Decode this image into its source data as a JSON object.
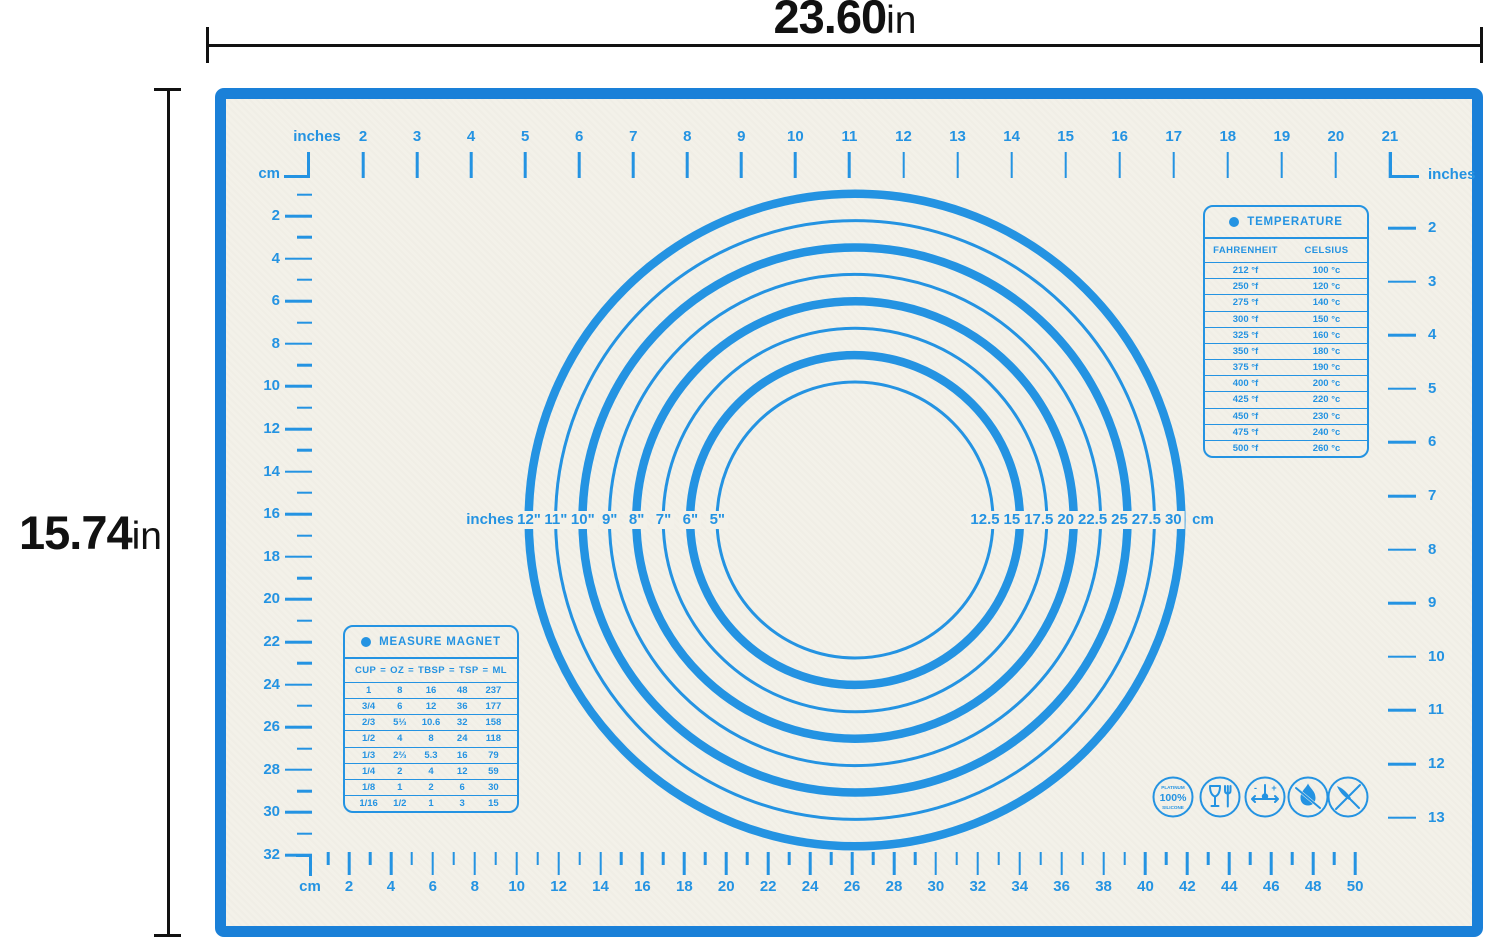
{
  "dimensions": {
    "width_value": "23.60",
    "width_unit": "in",
    "height_value": "15.74",
    "height_unit": "in"
  },
  "colors": {
    "border_blue": "#1a80d8",
    "print_blue": "#2493e2",
    "surface": "#f3f1e9",
    "dimension_black": "#111111"
  },
  "mat": {
    "rulers": {
      "top": {
        "unit": "inches",
        "numbers": [
          "2",
          "3",
          "4",
          "5",
          "6",
          "7",
          "8",
          "9",
          "10",
          "11",
          "12",
          "13",
          "14",
          "15",
          "16",
          "17",
          "18",
          "19",
          "20",
          "21"
        ]
      },
      "left": {
        "unit": "cm",
        "numbers": [
          "2",
          "4",
          "6",
          "8",
          "10",
          "12",
          "14",
          "16",
          "18",
          "20",
          "22",
          "24",
          "26",
          "28",
          "30",
          "32"
        ]
      },
      "right": {
        "unit": "inches",
        "numbers": [
          "2",
          "3",
          "4",
          "5",
          "6",
          "7",
          "8",
          "9",
          "10",
          "11",
          "12",
          "13"
        ]
      },
      "bottom": {
        "unit": "cm",
        "numbers": [
          "2",
          "4",
          "6",
          "8",
          "10",
          "12",
          "14",
          "16",
          "18",
          "20",
          "22",
          "24",
          "26",
          "28",
          "30",
          "32",
          "34",
          "36",
          "38",
          "40",
          "42",
          "44",
          "46",
          "48",
          "50"
        ]
      }
    },
    "circle_guide": {
      "left_unit": "inches",
      "inch_labels": [
        "12\"",
        "11\"",
        "10\"",
        "9\"",
        "8\"",
        "7\"",
        "6\"",
        "5\""
      ],
      "cm_labels": [
        "12.5",
        "15",
        "17.5",
        "20",
        "22.5",
        "25",
        "27.5",
        "30"
      ],
      "right_unit": "cm"
    },
    "temperature_panel": {
      "title": "TEMPERATURE",
      "columns": [
        "FAHRENHEIT",
        "CELSIUS"
      ],
      "rows": [
        [
          "212 °f",
          "100 °c"
        ],
        [
          "250 °f",
          "120 °c"
        ],
        [
          "275 °f",
          "140 °c"
        ],
        [
          "300 °f",
          "150 °c"
        ],
        [
          "325 °f",
          "160 °c"
        ],
        [
          "350 °f",
          "180 °c"
        ],
        [
          "375 °f",
          "190 °c"
        ],
        [
          "400 °f",
          "200 °c"
        ],
        [
          "425 °f",
          "220 °c"
        ],
        [
          "450 °f",
          "230 °c"
        ],
        [
          "475 °f",
          "240 °c"
        ],
        [
          "500 °f",
          "260 °c"
        ]
      ]
    },
    "measure_panel": {
      "title": "MEASURE MAGNET",
      "columns": [
        "CUP",
        "OZ",
        "TBSP",
        "TSP",
        "ML"
      ],
      "separator": "=",
      "rows": [
        [
          "1",
          "8",
          "16",
          "48",
          "237"
        ],
        [
          "3/4",
          "6",
          "12",
          "36",
          "177"
        ],
        [
          "2/3",
          "5⅓",
          "10.6",
          "32",
          "158"
        ],
        [
          "1/2",
          "4",
          "8",
          "24",
          "118"
        ],
        [
          "1/3",
          "2⅔",
          "5.3",
          "16",
          "79"
        ],
        [
          "1/4",
          "2",
          "4",
          "12",
          "59"
        ],
        [
          "1/8",
          "1",
          "2",
          "6",
          "30"
        ],
        [
          "1/16",
          "1/2",
          "1",
          "3",
          "15"
        ]
      ]
    },
    "badges": {
      "platinum": {
        "top": "PLATINUM",
        "center": "100%",
        "bottom": "SILICONE"
      },
      "icon_names": [
        "platinum-silicone-badge",
        "food-safe-icon",
        "heat-resistant-icon",
        "no-open-flame-icon",
        "no-knife-icon"
      ]
    }
  }
}
